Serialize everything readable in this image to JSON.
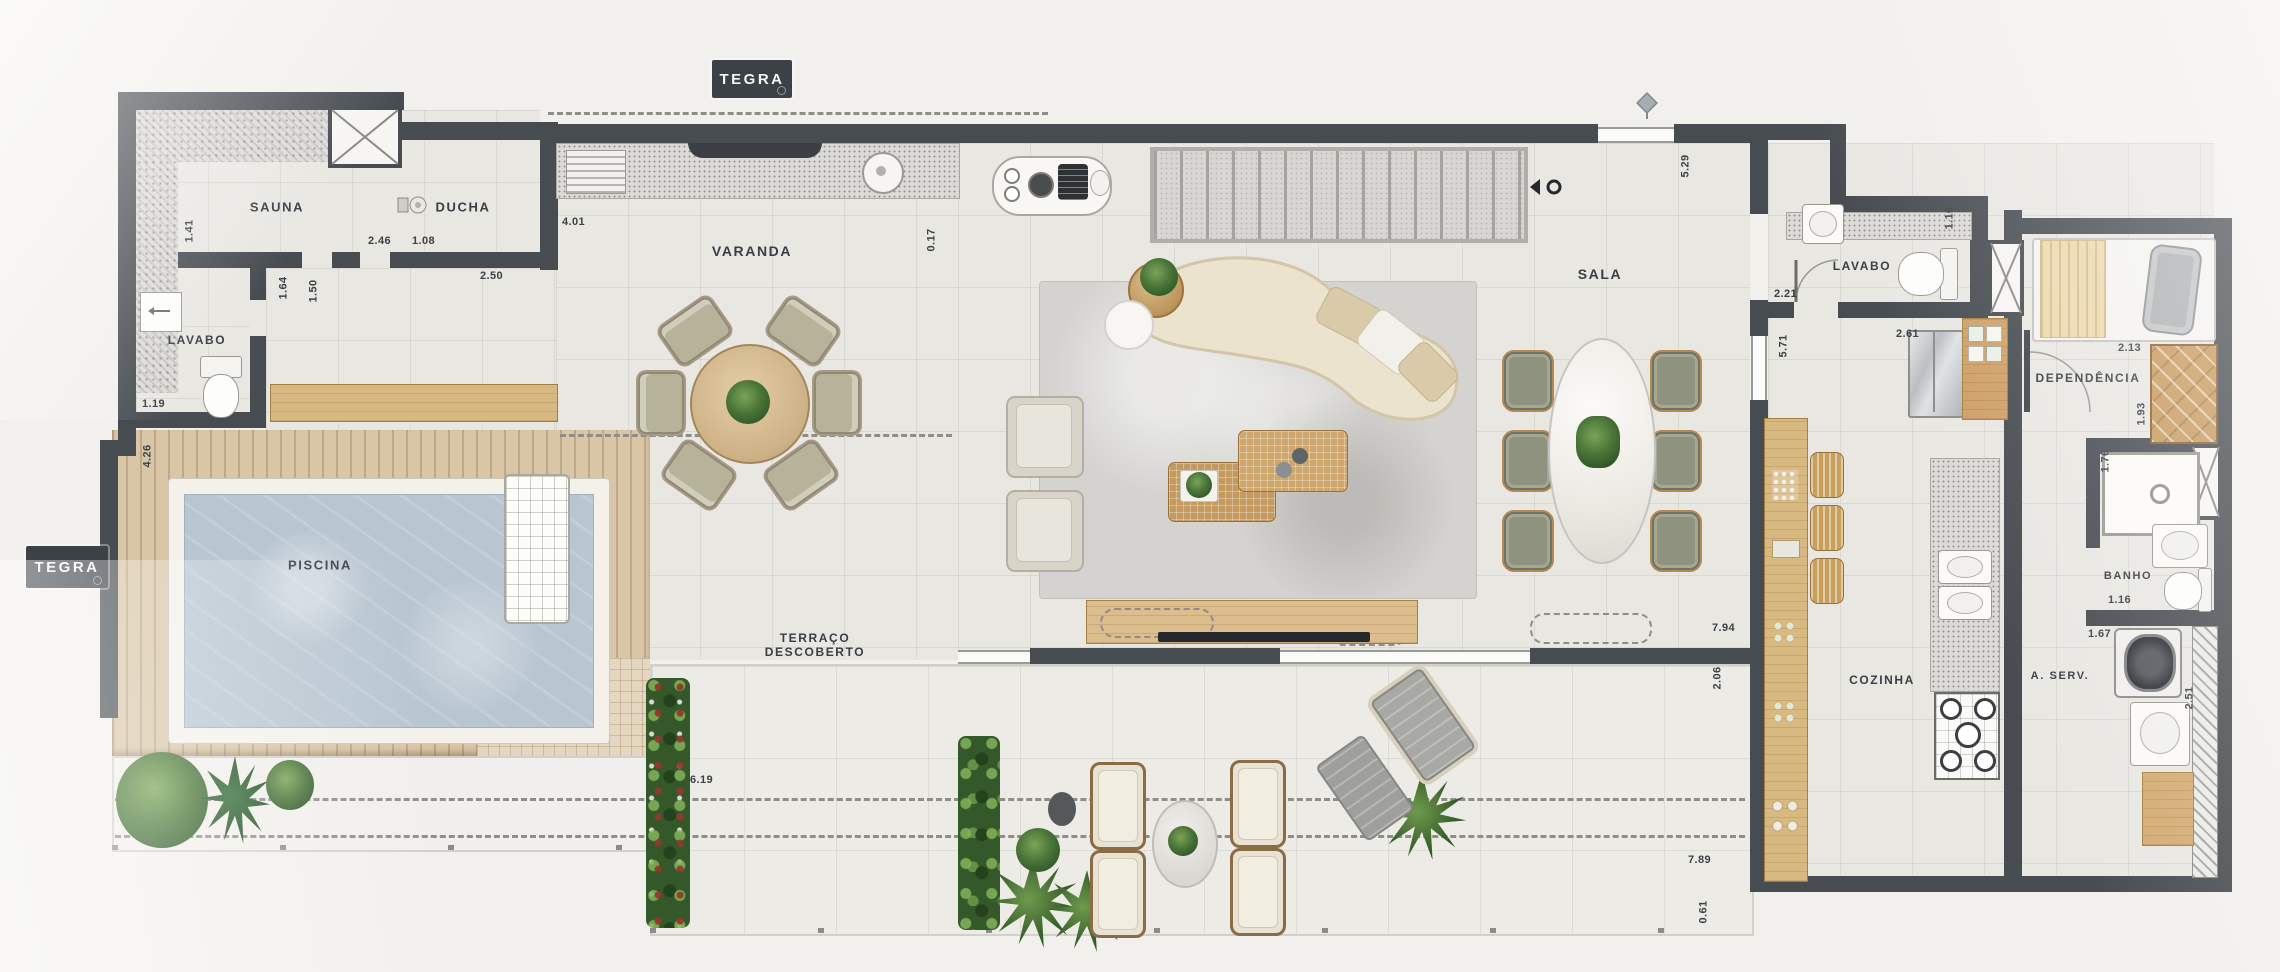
{
  "branding": {
    "logo": "TEGRA"
  },
  "rooms": {
    "sauna": "SAUNA",
    "ducha": "DUCHA",
    "lavabo1": "LAVABO",
    "varanda": "VARANDA",
    "sala": "SALA",
    "lavabo2": "LAVABO",
    "piscina": "PISCINA",
    "terraco_line1": "TERRAÇO",
    "terraco_line2": "DESCOBERTO",
    "dependencia": "DEPENDÊNCIA",
    "banho": "BANHO",
    "cozinha": "COZINHA",
    "aserv": "A. SERV."
  },
  "dims": {
    "sauna_side": "1.41",
    "sauna_width": "2.46",
    "ducha_entry": "1.08",
    "ducha_width": "2.50",
    "varanda_width": "4.01",
    "varanda_gap": "0.17",
    "hall_a": "1.64",
    "hall_b": "1.50",
    "lavabo1_width": "1.19",
    "deck_depth": "4.26",
    "entry_depth": "5.29",
    "lavabo2_depth": "1.16",
    "lavabo2_width": "2.21",
    "hall_depth": "5.71",
    "kitchen_width": "2.61",
    "dep_width": "2.13",
    "dep_depth": "1.93",
    "shower_depth": "1.76",
    "banho_width": "1.16",
    "aserv_width": "1.67",
    "aserv_depth": "2.51",
    "sala_width": "7.94",
    "sala_depth": "2.06",
    "terrace_width": "7.89",
    "terrace_edge": "0.61",
    "terraco_width": "6.19"
  }
}
